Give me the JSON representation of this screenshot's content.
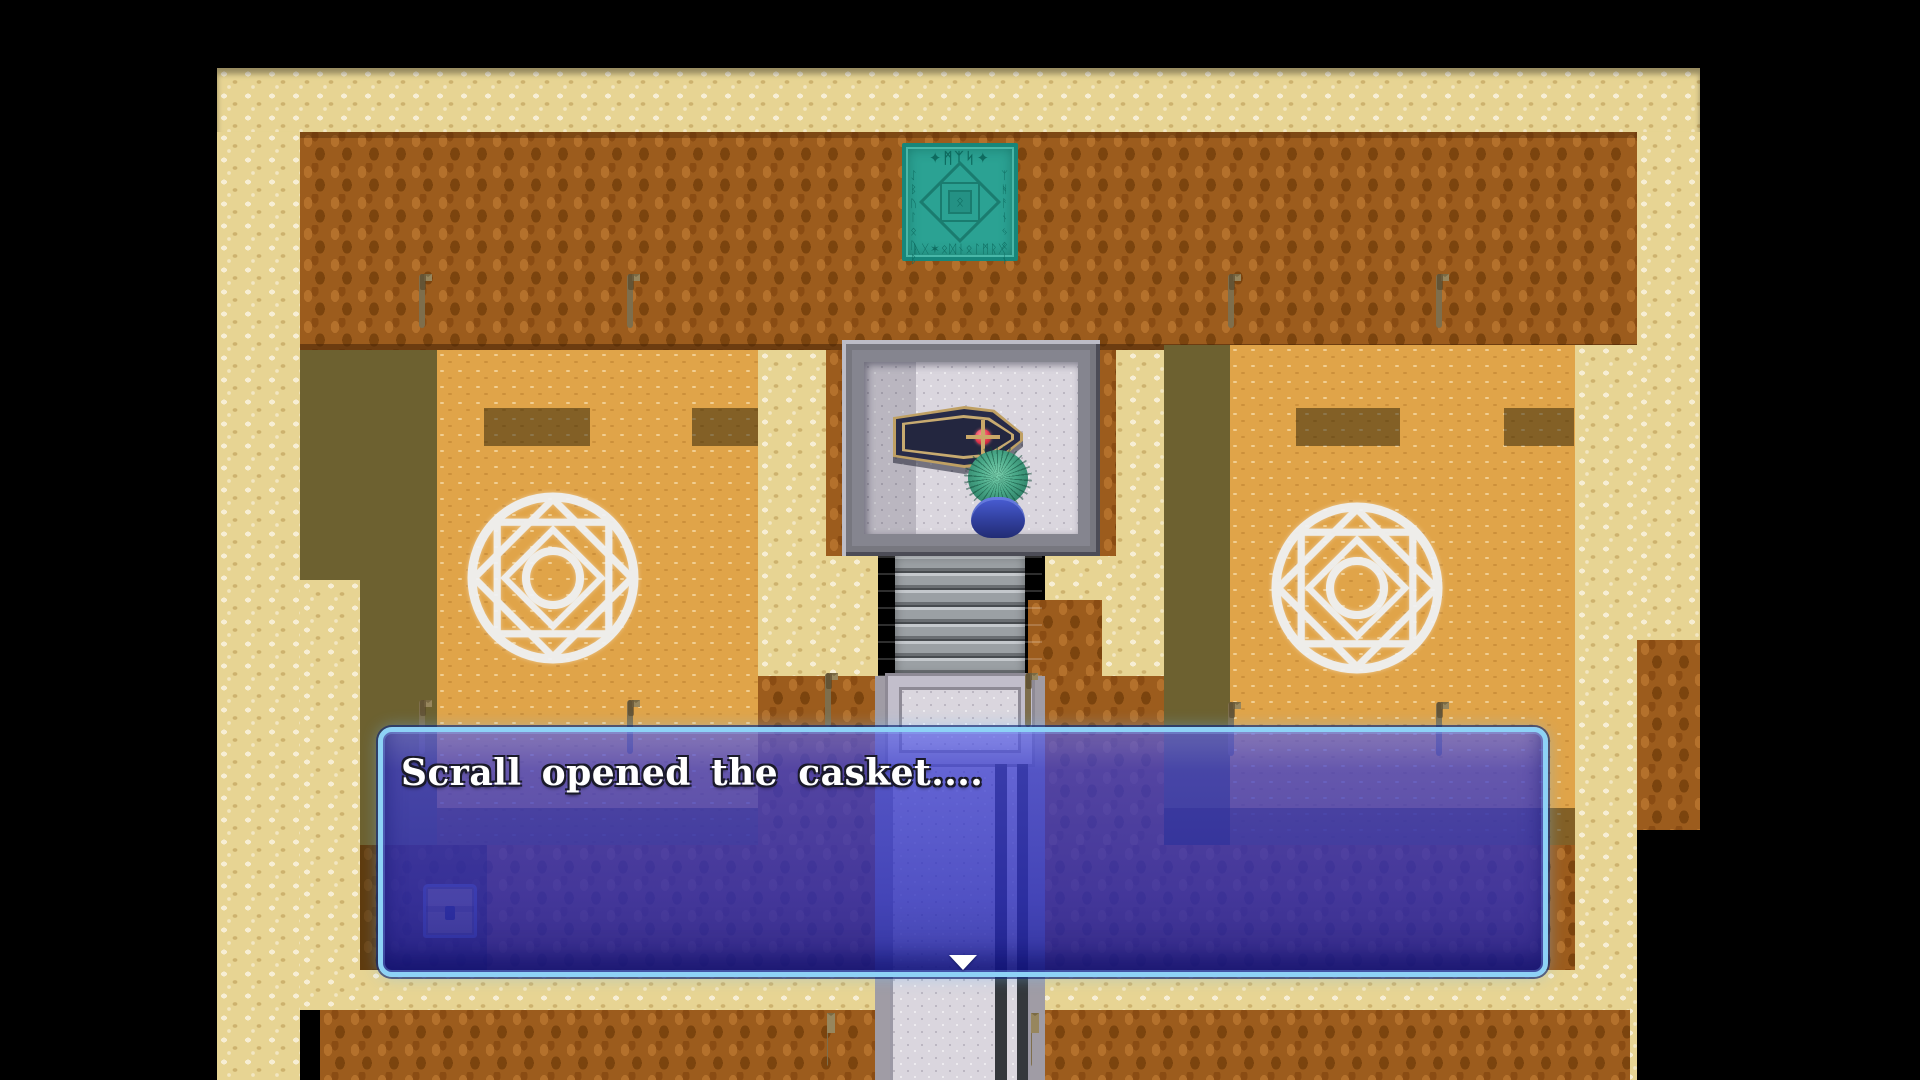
{
  "scene": {
    "name": "tomb-burial-chamber"
  },
  "dialogue": {
    "text": "Scrall opened the casket....",
    "continue_symbol": "▼",
    "box_fill": "#2f35c0",
    "border_color": "#8ed2f6",
    "text_color": "#ffffff"
  },
  "glyph_tile": {
    "header": "✦ᛗᛉᛋ✦",
    "left_column": "ᛇᛒᚢᛚᛟᚢᛒ",
    "right_column": "ᛉᚻᚨᚾᛃᛟᚾ",
    "bottom_row": "ᚣᚷ✶ᛟᛞᚾᛟᛚᛗᚱᚷ",
    "center_glyph": "ᛟ",
    "tile_color": "#2ba293"
  },
  "palette": {
    "floor_light": "#e7d493",
    "floor_orange": "#e0a449",
    "wall_brown": "#9c5c1d",
    "shadow_olive": "#6d6130",
    "marble": "#dad6de",
    "teal_tile": "#2ba293",
    "coffin_navy": "#23263f",
    "coffin_trim": "#c7aa70",
    "gem_red": "#e0344a",
    "hair_teal": "#49a888",
    "robe_blue": "#32409f",
    "magic_circle": "#f0f3f7"
  }
}
